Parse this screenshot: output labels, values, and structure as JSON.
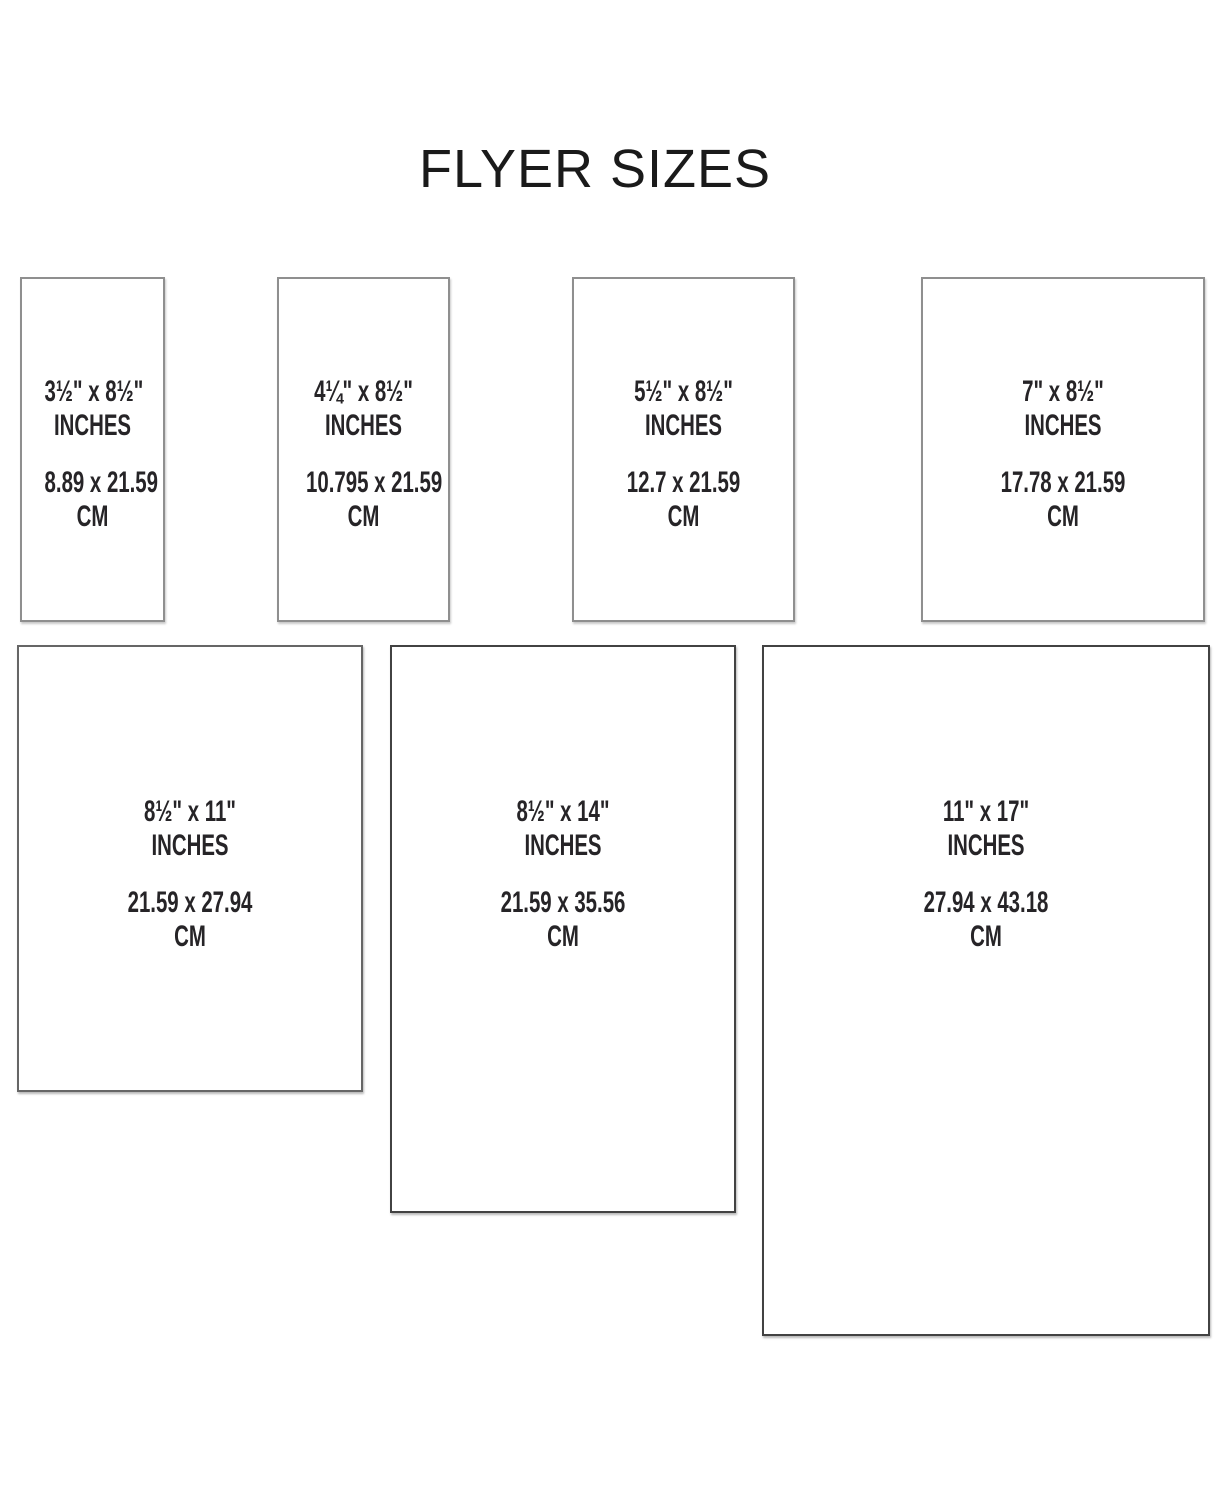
{
  "title": "FLYER SIZES",
  "flyers": [
    {
      "inch_dims": "3½\" x 8½\"",
      "inch_unit": "INCHES",
      "cm_dims": "8.89 x 21.59",
      "cm_unit": "CM"
    },
    {
      "inch_dims": "4¼\" x 8½\"",
      "inch_unit": "INCHES",
      "cm_dims": "10.795 x 21.59",
      "cm_unit": "CM"
    },
    {
      "inch_dims": "5½\" x 8½\"",
      "inch_unit": "INCHES",
      "cm_dims": "12.7 x 21.59",
      "cm_unit": "CM"
    },
    {
      "inch_dims": "7\" x 8½\"",
      "inch_unit": "INCHES",
      "cm_dims": "17.78 x 21.59",
      "cm_unit": "CM"
    },
    {
      "inch_dims": "8½\" x 11\"",
      "inch_unit": "INCHES",
      "cm_dims": "21.59 x 27.94",
      "cm_unit": "CM"
    },
    {
      "inch_dims": "8½\" x 14\"",
      "inch_unit": "INCHES",
      "cm_dims": "21.59 x 35.56",
      "cm_unit": "CM"
    },
    {
      "inch_dims": "11\" x 17\"",
      "inch_unit": "INCHES",
      "cm_dims": "27.94 x 43.18",
      "cm_unit": "CM"
    }
  ]
}
